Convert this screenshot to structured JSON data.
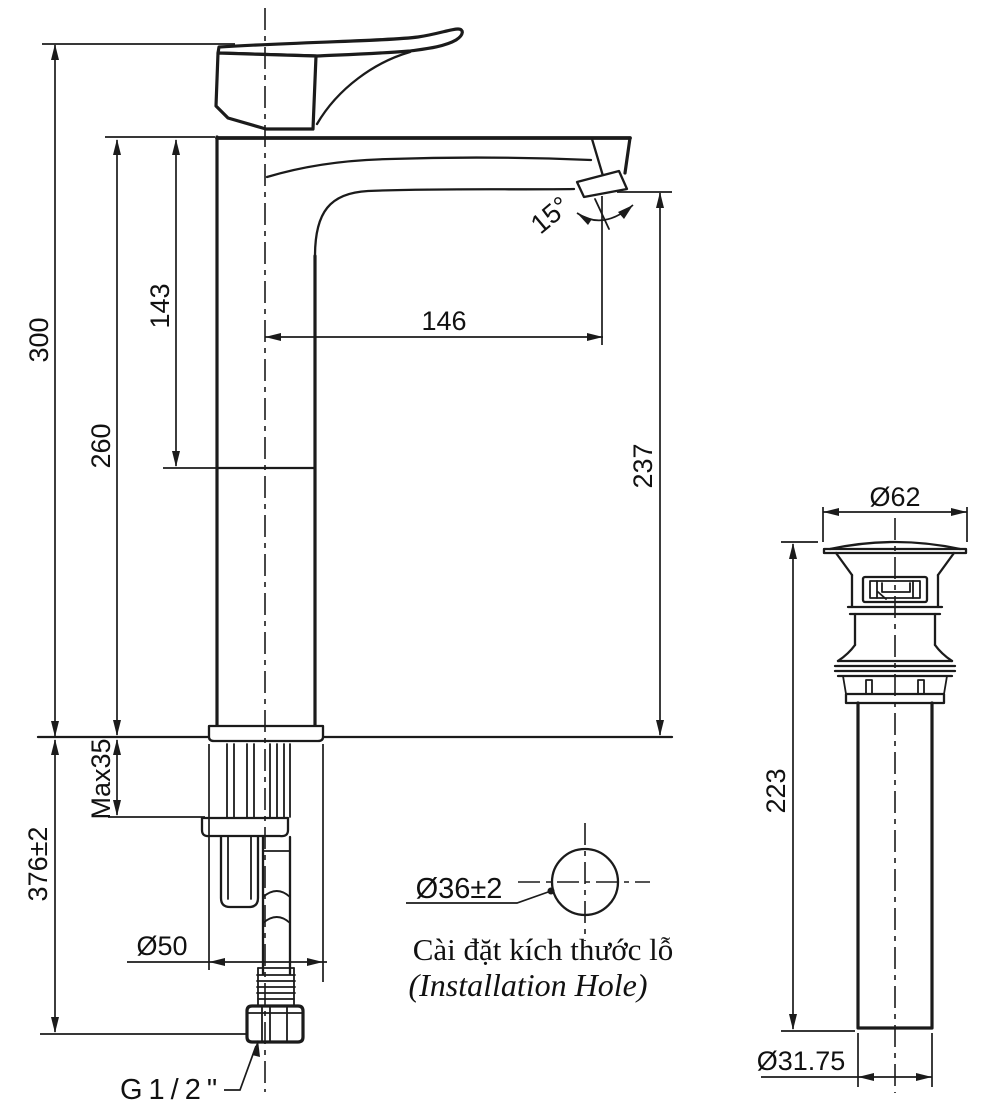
{
  "colors": {
    "ink": "#1b1b1b",
    "background": "#ffffff"
  },
  "faucet_view": {
    "dim_total_height": "300",
    "dim_body_top_height": "260",
    "dim_top_to_joint": "143",
    "dim_spout_reach": "146",
    "dim_outlet_height": "237",
    "dim_outlet_angle": "15°",
    "dim_max_deck_thickness": "Max35",
    "dim_below_counter_length": "376±2",
    "dim_base_diameter": "Ø50",
    "dim_thread_label": "G1/2\""
  },
  "installation_hole": {
    "dim_hole_diameter": "Ø36±2",
    "caption_vietnamese": "Cài đặt kích thước lỗ",
    "caption_english": "(Installation Hole)"
  },
  "drain_view": {
    "dim_flange_diameter": "Ø62",
    "dim_tail_length": "223",
    "dim_tail_diameter": "Ø31.75"
  }
}
